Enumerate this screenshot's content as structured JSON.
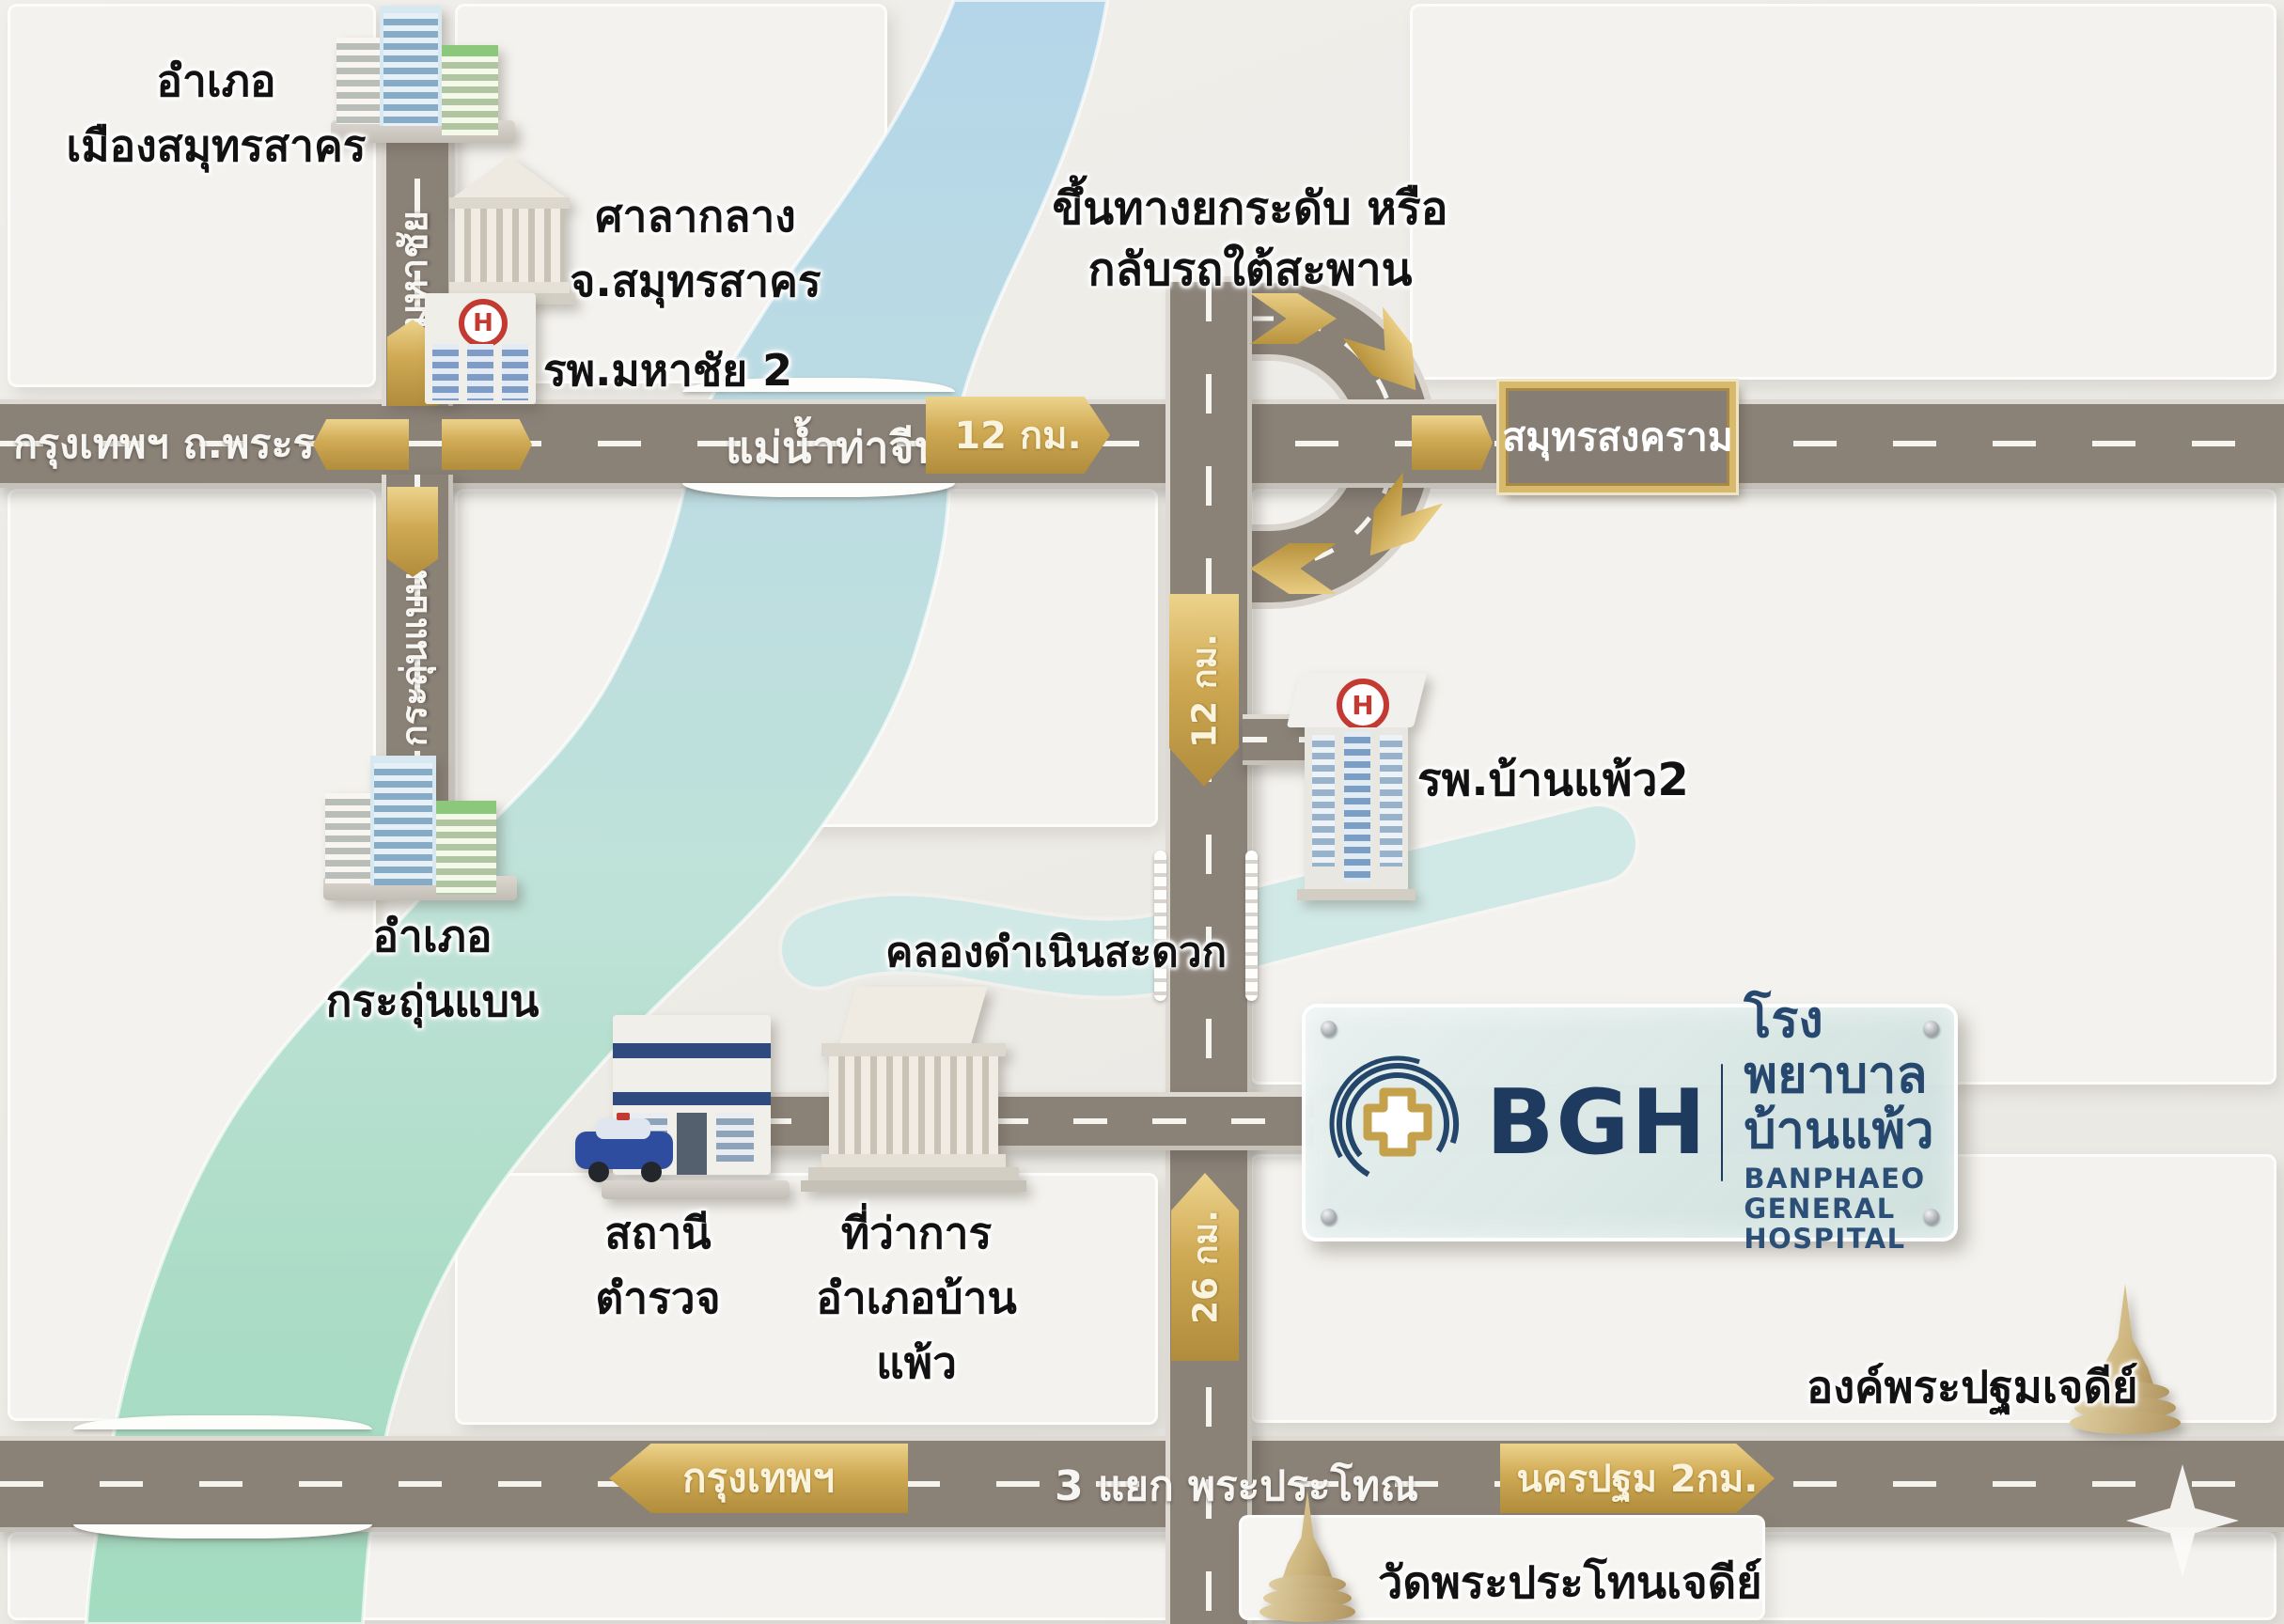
{
  "colors": {
    "background": "#efede9",
    "road": "#8a8177",
    "road_edge": "#dedad3",
    "dash_white": "#f6f4ef",
    "gold": "#cfa953",
    "river_blue": "#b7d8e8",
    "river_green": "#a5dcc0",
    "canal_teal": "#c2e2de",
    "navy": "#1f3a5f",
    "label_black": "#121212"
  },
  "top_left": {
    "district_line1": "อำเภอ",
    "district_line2": "เมืองสมุทรสาคร",
    "city_hall_line1": "ศาลากลาง",
    "city_hall_line2": "จ.สมุทรสาคร",
    "hospital": "รพ.มหาชัย 2",
    "road_label": "มหาชัย"
  },
  "rama2": {
    "road_label": "กรุงเทพฯ ถ.พระราม 2",
    "river_label": "แม่น้ำท่าจีน",
    "sign_12km": "12 กม.",
    "sign_samut_songkhram": "สมุทรสงคราม"
  },
  "uturn": {
    "note_line1": "ขึ้นทางยกระดับ หรือ",
    "note_line2": "กลับรถใต้สะพาน"
  },
  "mid_left": {
    "road_label": "กระถุ่นแบน",
    "district_line1": "อำเภอ",
    "district_line2": "กระถุ่นแบน"
  },
  "center": {
    "marker_12km": "12 กม.",
    "hospital2": "รพ.บ้านแพ้ว2",
    "canal_label": "คลองดำเนินสะดวก",
    "marker_26km": "26 กม."
  },
  "south_side": {
    "police_line1": "สถานี",
    "police_line2": "ตำรวจ",
    "office_line1": "ที่ว่าการ",
    "office_line2": "อำเภอบ้าน",
    "office_line3": "แพ้ว"
  },
  "bgh": {
    "abbr": "BGH",
    "name_thai": "โรงพยาบาลบ้านแพ้ว",
    "name_en": "BANPHAEO GENERAL HOSPITAL"
  },
  "bottom": {
    "sign_bangkok": "กรุงเทพฯ",
    "junction_label": "3 แยก พระประโทณ",
    "sign_nakhon_pathom": "นครปฐม 2กม.",
    "chedi_label": "องค์พระปฐมเจดีย์",
    "wat_label": "วัดพระประโทนเจดีย์"
  },
  "hospital_icon_letter": "H"
}
